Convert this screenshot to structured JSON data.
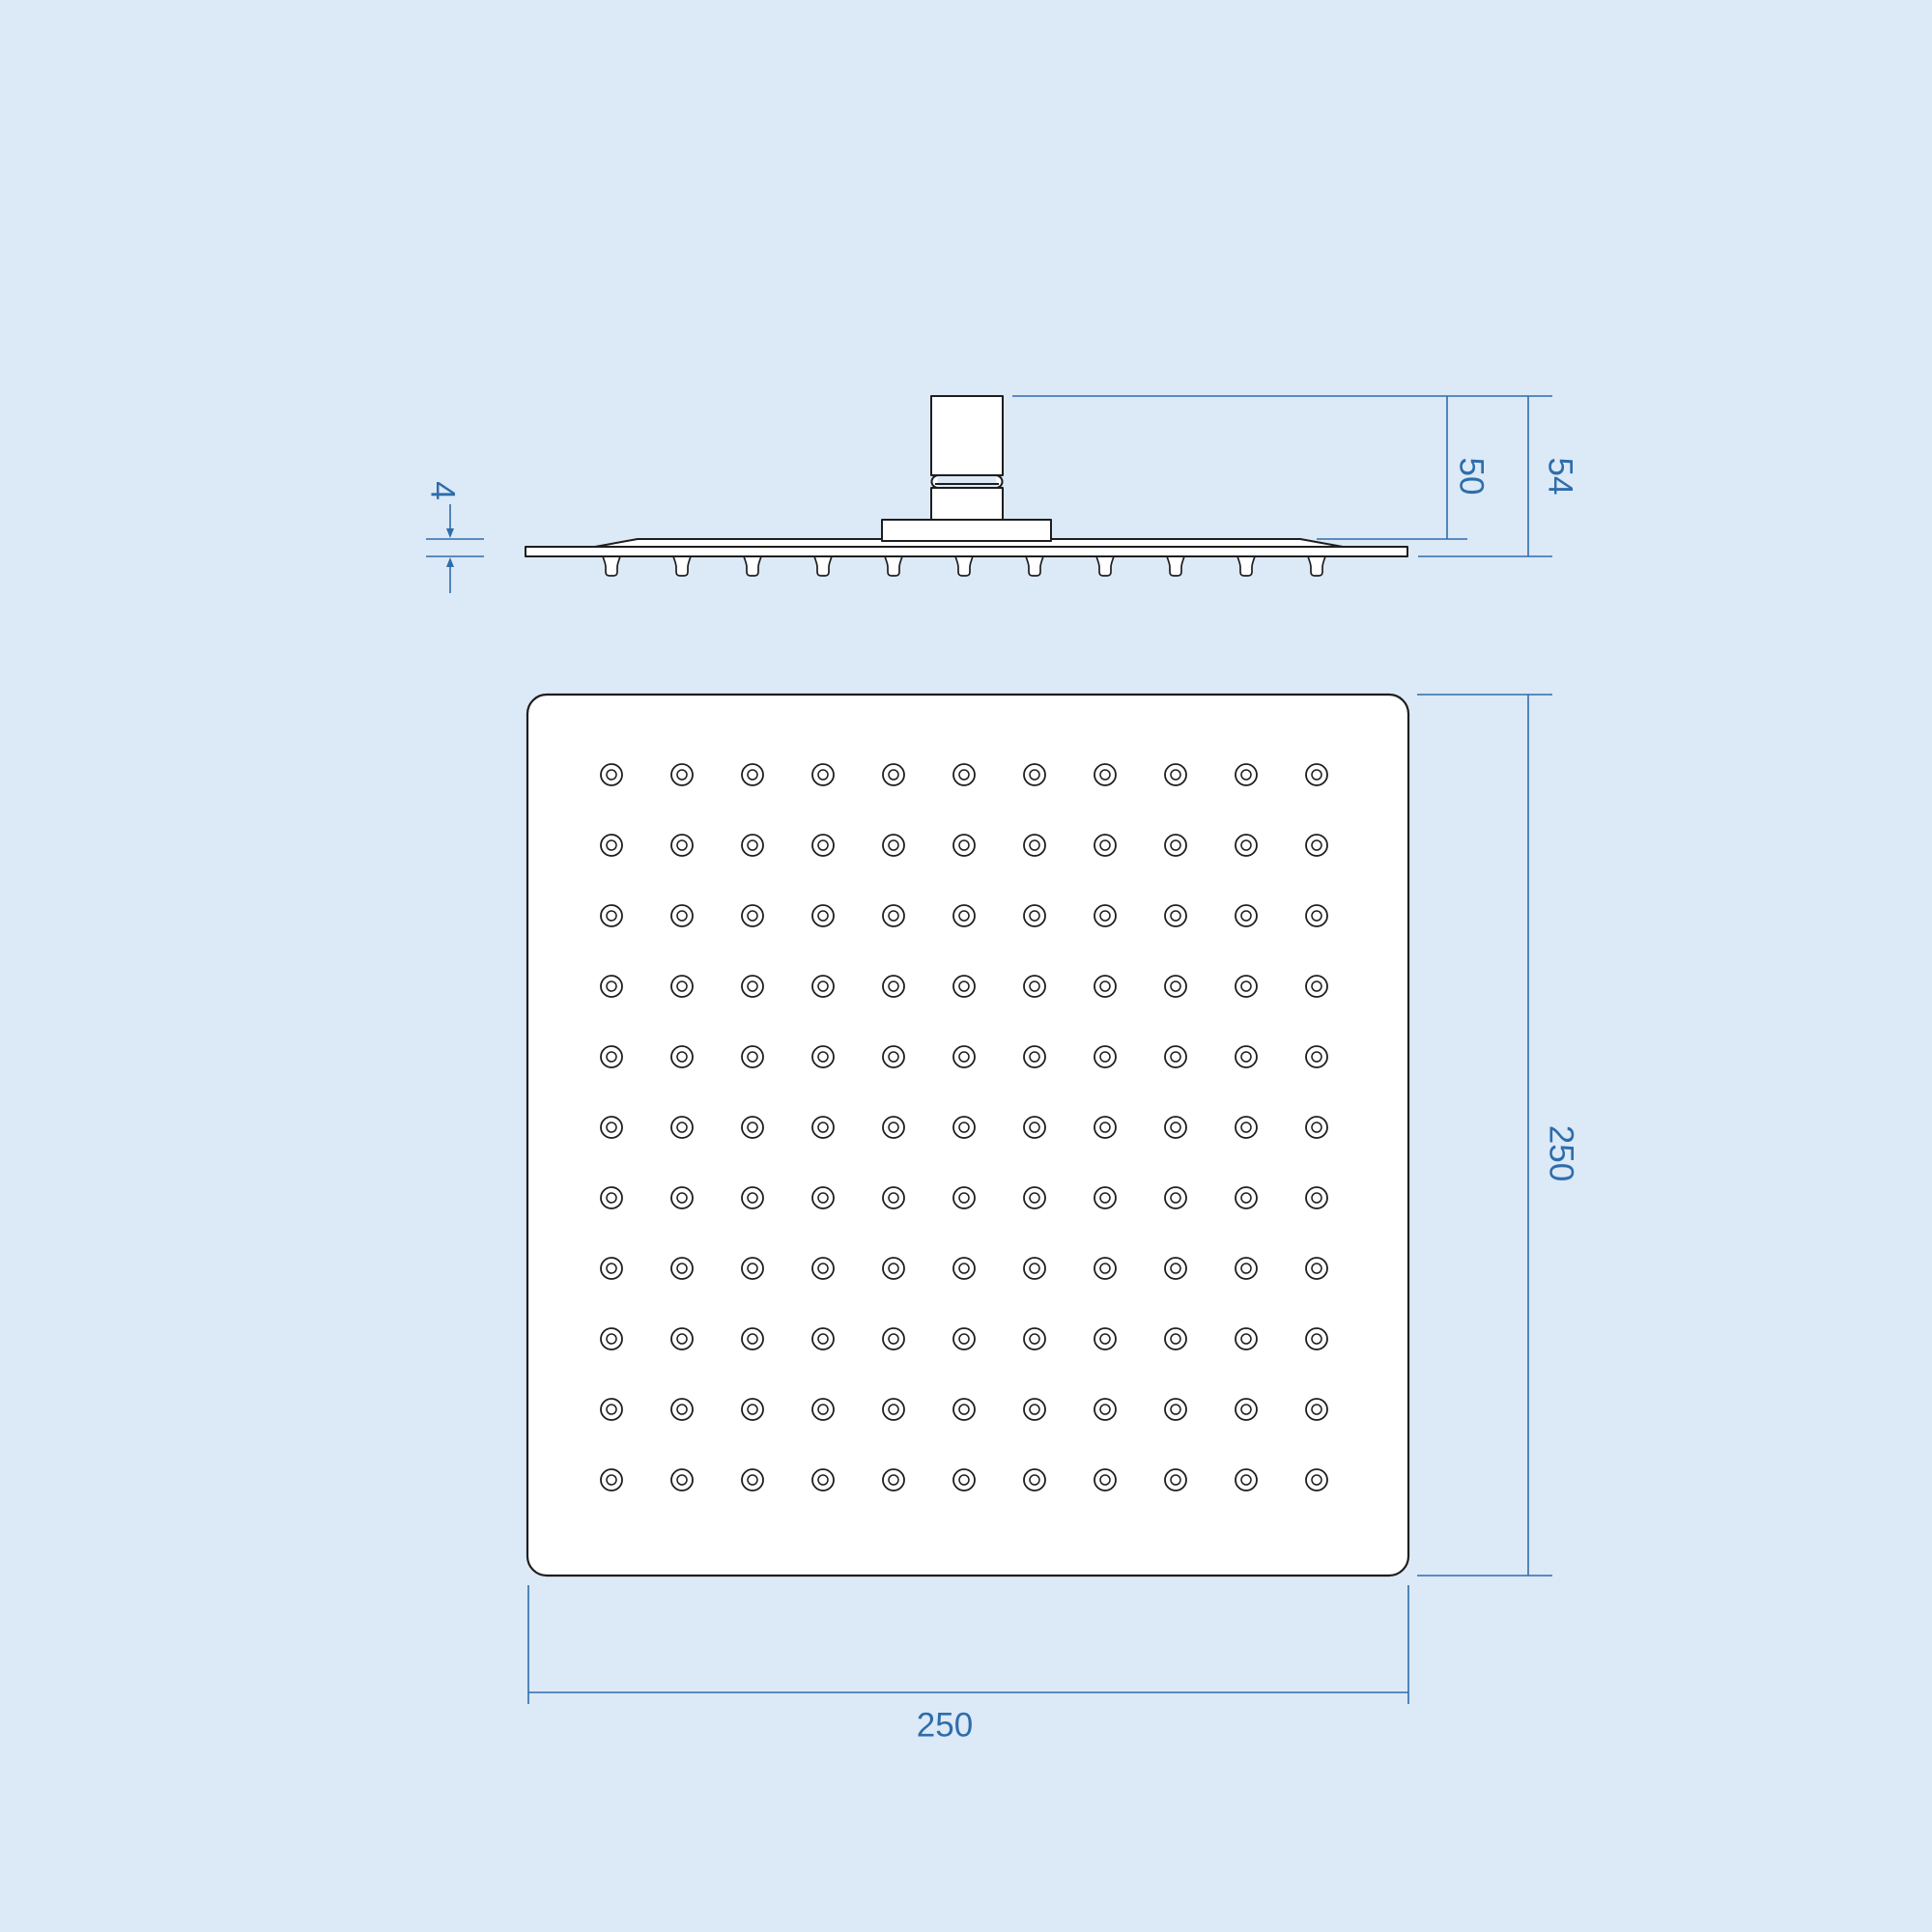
{
  "drawing": "square-shower-head-dimension-drawing",
  "colors": {
    "background": "#dce9f7",
    "outline": "#1e1e1e",
    "fill": "#ffffff",
    "dimension": "#2e6dab"
  },
  "side_view": {
    "labels": {
      "plate_thickness": "4",
      "connector_height": "50",
      "total_height": "54"
    },
    "nozzle_count": 11
  },
  "plan_view": {
    "labels": {
      "height": "250",
      "width": "250"
    },
    "nozzle_grid": {
      "rows": 11,
      "cols": 11
    }
  }
}
